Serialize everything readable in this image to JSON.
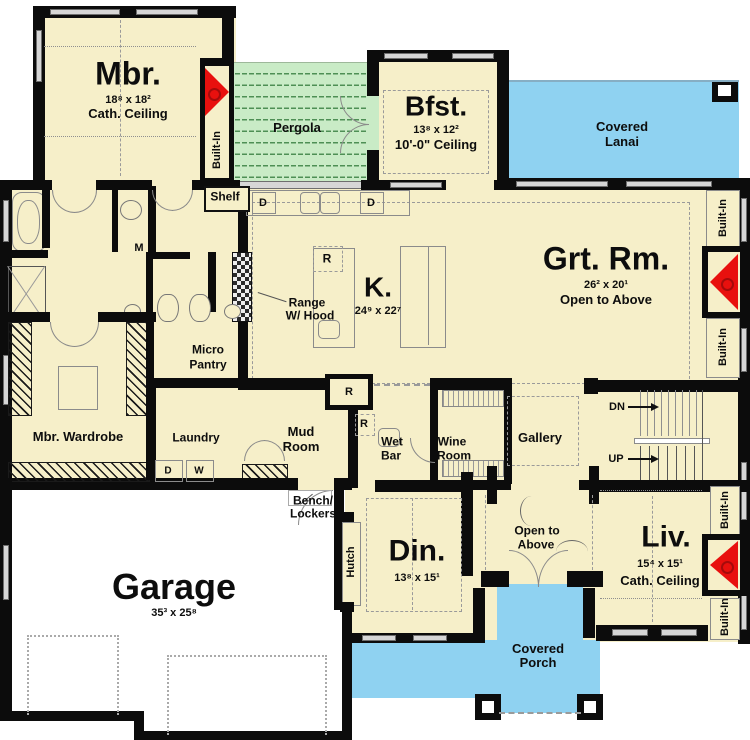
{
  "colors": {
    "floor": "#F6EFC9",
    "pergola_green": "#C9EBC6",
    "water_blue": "#8FD2F1",
    "fireplace_red": "#E8100E",
    "wall_black": "#0C0C0C",
    "garage_floor": "#FFFFFF"
  },
  "rooms": {
    "mbr": {
      "name": "Mbr.",
      "dim": "18⁸ x 18²",
      "note": "Cath. Ceiling"
    },
    "pergola": {
      "name": "Pergola"
    },
    "bfst": {
      "name": "Bfst.",
      "dim": "13⁸ x 12²",
      "note": "10'-0\" Ceiling"
    },
    "lanai": {
      "line1": "Covered",
      "line2": "Lanai"
    },
    "grt": {
      "name": "Grt. Rm.",
      "dim": "26² x 20¹",
      "note": "Open to Above"
    },
    "kitchen": {
      "name": "K.",
      "dim": "24⁹ x 22⁷"
    },
    "din": {
      "name": "Din.",
      "dim": "13⁸ x 15¹"
    },
    "liv": {
      "name": "Liv.",
      "dim": "15⁴ x 15¹",
      "note": "Cath. Ceiling"
    },
    "garage": {
      "name": "Garage",
      "dim": "35³ x 25⁸"
    },
    "porch": {
      "line1": "Covered",
      "line2": "Porch"
    },
    "entry": {
      "line1": "Open to",
      "line2": "Above"
    },
    "wardrobe": {
      "name": "Mbr. Wardrobe"
    },
    "laundry": {
      "name": "Laundry"
    },
    "mud": {
      "line1": "Mud",
      "line2": "Room"
    },
    "wetbar": {
      "line1": "Wet",
      "line2": "Bar"
    },
    "wine": {
      "line1": "Wine",
      "line2": "Room"
    },
    "gallery": {
      "name": "Gallery"
    },
    "pantry": {
      "line1": "Micro",
      "line2": "Pantry"
    },
    "bench": {
      "line1": "Bench/",
      "line2": "Lockers"
    }
  },
  "labels": {
    "shelf": "Shelf",
    "hutch": "Hutch",
    "built_in": "Built-In",
    "medicine": "M",
    "dn": "DN",
    "up": "UP",
    "range_line1": "Range",
    "range_line2": "W/ Hood",
    "dishwasher": "D",
    "dryer": "D",
    "washer": "W",
    "fridge": "R"
  }
}
